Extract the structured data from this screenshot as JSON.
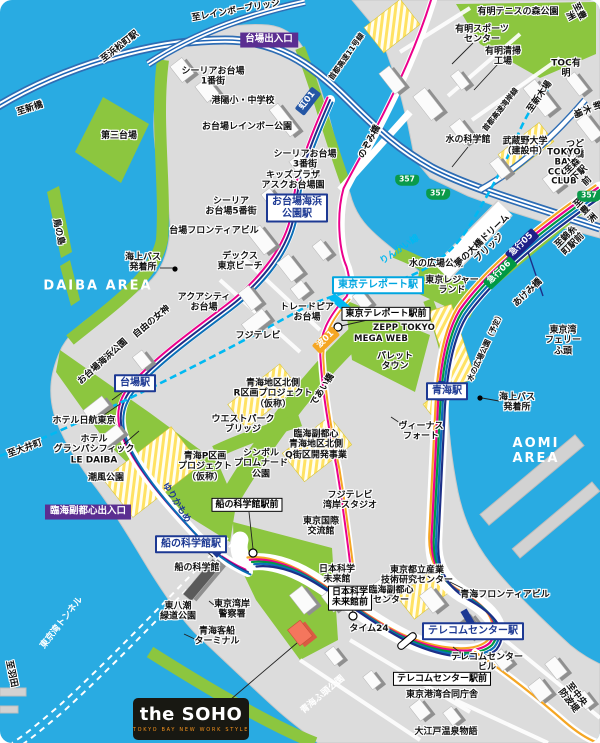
{
  "map_name": "the SOHO access map (Odaiba / Aomi area)",
  "areas": {
    "west": "DAIBA AREA",
    "east": "AOMI AREA"
  },
  "soho": {
    "logo_main": "the SOHO",
    "logo_sub": "TOKYO BAY NEW WORK STYLE"
  },
  "colors": {
    "water": "#29abe2",
    "land": "#dcdcdc",
    "park": "#8cc63f",
    "route_pink": "#ec008c",
    "route_yellow": "#f5a623",
    "route_green": "#009944",
    "route_blue": "#0b6fb8",
    "route_navy": "#1d2f88",
    "rinkai_cyan": "#00b9f2",
    "entrance_purple": "#5b2e91",
    "soho_orange": "#f4765d"
  },
  "labels": [
    {
      "name": "to-rainbow-bridge",
      "text": "至レインボーブリッジ",
      "x": 236,
      "y": 11,
      "rot": -10,
      "cls": "t"
    },
    {
      "name": "to-hamamatsucho-sta",
      "text": "至浜松町駅",
      "x": 120,
      "y": 47,
      "rot": -38,
      "cls": "t"
    },
    {
      "name": "to-shimbashi",
      "text": "至新橋",
      "x": 30,
      "y": 109,
      "rot": -18,
      "cls": "t"
    },
    {
      "name": "daiba-exit",
      "text": "台場出入口",
      "x": 269,
      "y": 40,
      "rot": 0,
      "cls": "ent"
    },
    {
      "name": "ceria-odaiba-1",
      "text": "シーリアお台場\n1番街",
      "x": 213,
      "y": 77,
      "rot": 0,
      "cls": "t"
    },
    {
      "name": "koyo-school",
      "text": "港陽小・中学校",
      "x": 243,
      "y": 101,
      "rot": 0,
      "cls": "t"
    },
    {
      "name": "odaiba-rainbow-park",
      "text": "お台場レインボー公園",
      "x": 247,
      "y": 127,
      "rot": 0,
      "cls": "t"
    },
    {
      "name": "dai-san-daiba",
      "text": "第三台場",
      "x": 119,
      "y": 136,
      "rot": 0,
      "cls": "t"
    },
    {
      "name": "ceria-odaiba-3",
      "text": "シーリアお台場\n3番街",
      "x": 305,
      "y": 160,
      "rot": 0,
      "cls": "t"
    },
    {
      "name": "kids-plaza-ask-odaiba",
      "text": "キッズプラザ\nアスクお台場園",
      "x": 293,
      "y": 181,
      "rot": 0,
      "cls": "t"
    },
    {
      "name": "odaiba-kaihinkoen-sta",
      "text": "お台場海浜\n公園駅",
      "x": 297,
      "y": 208,
      "rot": 0,
      "cls": "sta"
    },
    {
      "name": "ceria-odaiba-5",
      "text": "シーリア\nお台場5番街",
      "x": 231,
      "y": 207,
      "rot": 0,
      "cls": "t"
    },
    {
      "name": "daiba-frontier-bldg",
      "text": "台場フロンティアビル",
      "x": 214,
      "y": 231,
      "rot": 0,
      "cls": "t"
    },
    {
      "name": "decks-tokyo-beach",
      "text": "デックス\n東京ビーチ",
      "x": 240,
      "y": 262,
      "rot": 0,
      "cls": "t"
    },
    {
      "name": "aqua-city-odaiba",
      "text": "アクアシティ\nお台場",
      "x": 204,
      "y": 303,
      "rot": 0,
      "cls": "t"
    },
    {
      "name": "trade-pia-odaiba",
      "text": "トレードピア\nお台場",
      "x": 307,
      "y": 313,
      "rot": 0,
      "cls": "t"
    },
    {
      "name": "fuji-tv",
      "text": "フジテレビ",
      "x": 258,
      "y": 336,
      "rot": 0,
      "cls": "t"
    },
    {
      "name": "statue-of-liberty",
      "text": "自由の女神",
      "x": 152,
      "y": 322,
      "rot": -40,
      "cls": "t"
    },
    {
      "name": "odaiba-kaihin-park",
      "text": "お台場海浜公園",
      "x": 103,
      "y": 362,
      "rot": -42,
      "cls": "t"
    },
    {
      "name": "tori-no-shima",
      "text": "鳥の島",
      "x": 58,
      "y": 232,
      "rot": 78,
      "cls": "t"
    },
    {
      "name": "daiba-area",
      "text": "DAIBA AREA",
      "x": 98,
      "y": 287,
      "rot": 0,
      "cls": "area"
    },
    {
      "name": "seabus-terminal-west",
      "text": "海上バス\n発着所",
      "x": 143,
      "y": 263,
      "rot": 0,
      "cls": "t"
    },
    {
      "name": "mizu-no-kagakukan",
      "text": "水の科学館",
      "x": 468,
      "y": 140,
      "rot": 0,
      "cls": "t"
    },
    {
      "name": "ariake-sports-center",
      "text": "有明スポーツ\nセンター",
      "x": 482,
      "y": 35,
      "rot": 0,
      "cls": "t"
    },
    {
      "name": "ariake-incineration-plant",
      "text": "有明清掃\n工場",
      "x": 503,
      "y": 57,
      "rot": 0,
      "cls": "t"
    },
    {
      "name": "ariake-tennis-park",
      "text": "有明テニスの森公園",
      "x": 518,
      "y": 12,
      "rot": 0,
      "cls": "t"
    },
    {
      "name": "toc-ariake",
      "text": "TOC有明",
      "x": 566,
      "y": 69,
      "rot": 0,
      "cls": "t"
    },
    {
      "name": "to-toyosu-top",
      "text": "至豊洲",
      "x": 574,
      "y": 14,
      "rot": 62,
      "cls": "t"
    },
    {
      "name": "shuto-expwy-11",
      "text": "首都高速11号線",
      "x": 347,
      "y": 57,
      "rot": -55,
      "cls": "t sm"
    },
    {
      "name": "nozomi-bridge",
      "text": "のぞみ橋",
      "x": 370,
      "y": 142,
      "rot": -62,
      "cls": "t"
    },
    {
      "name": "shuto-expwy-wangan",
      "text": "首都高速湾岸線",
      "x": 501,
      "y": 110,
      "rot": -52,
      "cls": "t sm"
    },
    {
      "name": "to-shinkiba-rail",
      "text": "至新木場",
      "x": 540,
      "y": 97,
      "rot": -55,
      "cls": "t"
    },
    {
      "name": "to-shinkiba-road",
      "text": "至新木場",
      "x": 591,
      "y": 108,
      "rot": 68,
      "cls": "t"
    },
    {
      "name": "musashino-univ",
      "text": "武蔵野大学\n（建設中）",
      "x": 525,
      "y": 147,
      "rot": 0,
      "cls": "t"
    },
    {
      "name": "tsudoi-bridge",
      "text": "つどい橋",
      "x": 575,
      "y": 150,
      "rot": 0,
      "cls": "t"
    },
    {
      "name": "tokyo-bay-court-club",
      "text": "TOKYO BAY\nCCURT CLUB",
      "x": 564,
      "y": 168,
      "rot": 0,
      "cls": "t lat"
    },
    {
      "name": "mizunohiroba-park",
      "text": "水の広場公園",
      "x": 436,
      "y": 264,
      "rot": 0,
      "cls": "t"
    },
    {
      "name": "tokyo-teleport-sta",
      "text": "東京テレポート駅",
      "x": 378,
      "y": 285,
      "rot": 0,
      "cls": "sta cyan"
    },
    {
      "name": "rinkai-line",
      "text": "りんかい線",
      "x": 400,
      "y": 250,
      "rot": -34,
      "cls": "L cyn"
    },
    {
      "name": "tokyo-teleport-ekimae",
      "text": "東京テレポート駅前",
      "x": 386,
      "y": 314,
      "rot": 0,
      "cls": "bus"
    },
    {
      "name": "zepp-tokyo",
      "text": "ZEPP TOKYO",
      "x": 404,
      "y": 329,
      "rot": 0,
      "cls": "t lat"
    },
    {
      "name": "mega-web",
      "text": "MEGA WEB",
      "x": 381,
      "y": 340,
      "rot": 0,
      "cls": "t lat"
    },
    {
      "name": "palette-town",
      "text": "パレット\nタウン",
      "x": 395,
      "y": 362,
      "rot": 0,
      "cls": "t"
    },
    {
      "name": "tokyo-leisure-land",
      "text": "東京レジャー\nランド",
      "x": 452,
      "y": 286,
      "rot": 0,
      "cls": "t"
    },
    {
      "name": "yume-no-ohashi-dream-bridge",
      "text": "夢の大橋ドリーム\nブリッジ",
      "x": 486,
      "y": 245,
      "rot": -44,
      "cls": "t"
    },
    {
      "name": "kyuko-05-badge",
      "text": "急行05",
      "x": 522,
      "y": 245,
      "rot": -44,
      "cls": "bdg navy"
    },
    {
      "name": "kyuko-06-badge",
      "text": "急行06",
      "x": 500,
      "y": 273,
      "rot": -44,
      "cls": "bdg grn"
    },
    {
      "name": "akemi-bridge",
      "text": "あけみ橋",
      "x": 528,
      "y": 293,
      "rot": -44,
      "cls": "t"
    },
    {
      "name": "to-morishita-ekimae",
      "text": "至森下駅前",
      "x": 580,
      "y": 174,
      "rot": -44,
      "cls": "t"
    },
    {
      "name": "to-toyosu-right",
      "text": "至豊洲",
      "x": 586,
      "y": 211,
      "rot": -44,
      "cls": "t"
    },
    {
      "name": "to-kinshicho-ekimae",
      "text": "至錦糸町駅前",
      "x": 570,
      "y": 241,
      "rot": -44,
      "cls": "t"
    },
    {
      "name": "tokyo-bay-ferry-pier",
      "text": "東京湾\nフェリーふ頭",
      "x": 563,
      "y": 341,
      "rot": 0,
      "cls": "t"
    },
    {
      "name": "aomi-sta",
      "text": "青海駅",
      "x": 447,
      "y": 391,
      "rot": 0,
      "cls": "sta"
    },
    {
      "name": "mizunohiroba-park-planned",
      "text": "水の広場公園（予定）",
      "x": 486,
      "y": 347,
      "rot": -65,
      "cls": "t sm"
    },
    {
      "name": "venus-fort",
      "text": "ヴィーナス\nフォート",
      "x": 421,
      "y": 432,
      "rot": 0,
      "cls": "t"
    },
    {
      "name": "aomi-area",
      "text": "AOMI AREA",
      "x": 536,
      "y": 452,
      "rot": 0,
      "cls": "area"
    },
    {
      "name": "seabus-terminal-east",
      "text": "海上バス\n発着所",
      "x": 517,
      "y": 403,
      "rot": 0,
      "cls": "t"
    },
    {
      "name": "yurikamome-line",
      "text": "ゆりかもめ",
      "x": 176,
      "y": 503,
      "rot": 58,
      "cls": "L nvy"
    },
    {
      "name": "daiba-sta",
      "text": "台場駅",
      "x": 135,
      "y": 383,
      "rot": 0,
      "cls": "sta"
    },
    {
      "name": "hotel-nikko-tokyo",
      "text": "ホテル日航東京",
      "x": 84,
      "y": 421,
      "rot": 0,
      "cls": "t"
    },
    {
      "name": "hotel-grand-pacific-le-daiba",
      "text": "ホテル\nグランパシフィック\nLE DAIBA",
      "x": 94,
      "y": 450,
      "rot": 0,
      "cls": "t"
    },
    {
      "name": "shiokaze-park",
      "text": "潮風公園",
      "x": 106,
      "y": 478,
      "rot": 0,
      "cls": "t"
    },
    {
      "name": "to-oimachi",
      "text": "至大井町",
      "x": 25,
      "y": 449,
      "rot": -20,
      "cls": "t"
    },
    {
      "name": "rinkai-fukutoshin-exit",
      "text": "臨海副都心出入口",
      "x": 88,
      "y": 512,
      "rot": 0,
      "cls": "ent"
    },
    {
      "name": "aomi-p-project",
      "text": "青海P区画\nプロジェクト\n（仮称）",
      "x": 205,
      "y": 467,
      "rot": 0,
      "cls": "t"
    },
    {
      "name": "west-park-bridge",
      "text": "ウエストパーク\nブリッジ",
      "x": 243,
      "y": 425,
      "rot": 0,
      "cls": "t"
    },
    {
      "name": "symbol-promenade-park",
      "text": "シンボル\nプロムナード\n公園",
      "x": 261,
      "y": 464,
      "rot": 0,
      "cls": "t"
    },
    {
      "name": "aomi-north-r-project",
      "text": "青海地区北側\nR区画プロジェクト\n（仮称）",
      "x": 273,
      "y": 394,
      "rot": 0,
      "cls": "t"
    },
    {
      "name": "aomi-north-q-project",
      "text": "臨海副都心\n青海地区北側\nQ街区開発事業",
      "x": 316,
      "y": 445,
      "rot": 0,
      "cls": "t"
    },
    {
      "name": "deai-bridge",
      "text": "であい橋",
      "x": 323,
      "y": 390,
      "rot": -58,
      "cls": "t"
    },
    {
      "name": "nami-01-badge",
      "text": "波01",
      "x": 326,
      "y": 340,
      "rot": -44,
      "cls": "bdg org"
    },
    {
      "name": "niji-01-badge",
      "text": "虹01",
      "x": 308,
      "y": 101,
      "rot": -52,
      "cls": "bdg blu"
    },
    {
      "name": "fujitv-bay-studio",
      "text": "フジテレビ\n湾岸スタジオ",
      "x": 350,
      "y": 501,
      "rot": 0,
      "cls": "t"
    },
    {
      "name": "tokyo-intl-exchange",
      "text": "東京国際\n交流館",
      "x": 321,
      "y": 527,
      "rot": 0,
      "cls": "t"
    },
    {
      "name": "funenokagakukan-ekimae",
      "text": "船の科学館駅前",
      "x": 247,
      "y": 505,
      "rot": 0,
      "cls": "bus"
    },
    {
      "name": "funenokagakukan-sta",
      "text": "船の科学館駅",
      "x": 191,
      "y": 544,
      "rot": 0,
      "cls": "sta"
    },
    {
      "name": "funenokagakukan",
      "text": "船の科学館",
      "x": 197,
      "y": 568,
      "rot": 0,
      "cls": "t"
    },
    {
      "name": "higashiyashio-ryokudo-park",
      "text": "東八潮\n緑道公園",
      "x": 178,
      "y": 612,
      "rot": 0,
      "cls": "t"
    },
    {
      "name": "tokyo-bay-police",
      "text": "東京湾岸\n警察署",
      "x": 232,
      "y": 610,
      "rot": 0,
      "cls": "t"
    },
    {
      "name": "aomi-passenger-terminal",
      "text": "青海客船\nターミナル",
      "x": 217,
      "y": 637,
      "rot": 0,
      "cls": "t"
    },
    {
      "name": "tokyo-bay-tunnel",
      "text": "東京湾トンネル",
      "x": 62,
      "y": 623,
      "rot": -52,
      "cls": "L wht t wht"
    },
    {
      "name": "to-haneda",
      "text": "至羽田",
      "x": 11,
      "y": 674,
      "rot": 78,
      "cls": "t"
    },
    {
      "name": "time-24",
      "text": "タイム24",
      "x": 369,
      "y": 629,
      "rot": 0,
      "cls": "t"
    },
    {
      "name": "miraikan",
      "text": "日本科学\n未来館",
      "x": 337,
      "y": 575,
      "rot": 0,
      "cls": "t"
    },
    {
      "name": "miraikan-mae",
      "text": "日本科学\n未来館前",
      "x": 350,
      "y": 598,
      "rot": 0,
      "cls": "bus"
    },
    {
      "name": "sangyo-gijutsu-center",
      "text": "東京都立産業\n技術研究センター",
      "x": 417,
      "y": 576,
      "rot": 0,
      "cls": "t"
    },
    {
      "name": "rinkai-fukutoshin-center",
      "text": "臨海副都心\nセンター",
      "x": 391,
      "y": 596,
      "rot": 0,
      "cls": "t"
    },
    {
      "name": "telecom-center-sta",
      "text": "テレコムセンター駅",
      "x": 473,
      "y": 631,
      "rot": 0,
      "cls": "sta"
    },
    {
      "name": "telecom-center-bldg",
      "text": "テレコムセンター\nビル",
      "x": 487,
      "y": 663,
      "rot": 0,
      "cls": "t"
    },
    {
      "name": "telecom-center-ekimae",
      "text": "テレコムセンター駅前",
      "x": 442,
      "y": 679,
      "rot": 0,
      "cls": "bus"
    },
    {
      "name": "tokyo-port-godochosha",
      "text": "東京港湾合同庁舎",
      "x": 442,
      "y": 695,
      "rot": 0,
      "cls": "t"
    },
    {
      "name": "ooedo-onsen-monogatari",
      "text": "大江戸温泉物語",
      "x": 446,
      "y": 732,
      "rot": 0,
      "cls": "t"
    },
    {
      "name": "aomi-frontier-bldg",
      "text": "青海フロンティアビル",
      "x": 505,
      "y": 595,
      "rot": 0,
      "cls": "t"
    },
    {
      "name": "aomi-futo-park",
      "text": "青海ふ頭公園",
      "x": 323,
      "y": 695,
      "rot": -40,
      "cls": "L wht t wht"
    },
    {
      "name": "to-chuo-bohatei",
      "text": "至中央防波堤",
      "x": 572,
      "y": 698,
      "rot": 52,
      "cls": "t"
    },
    {
      "name": "route-357-a",
      "text": "357",
      "x": 407,
      "y": 180,
      "rot": 0,
      "cls": "shield"
    },
    {
      "name": "route-357-b",
      "text": "357",
      "x": 438,
      "y": 194,
      "rot": 0,
      "cls": "shield"
    },
    {
      "name": "route-357-c",
      "text": "357",
      "x": 589,
      "y": 196,
      "rot": 0,
      "cls": "shield"
    }
  ]
}
